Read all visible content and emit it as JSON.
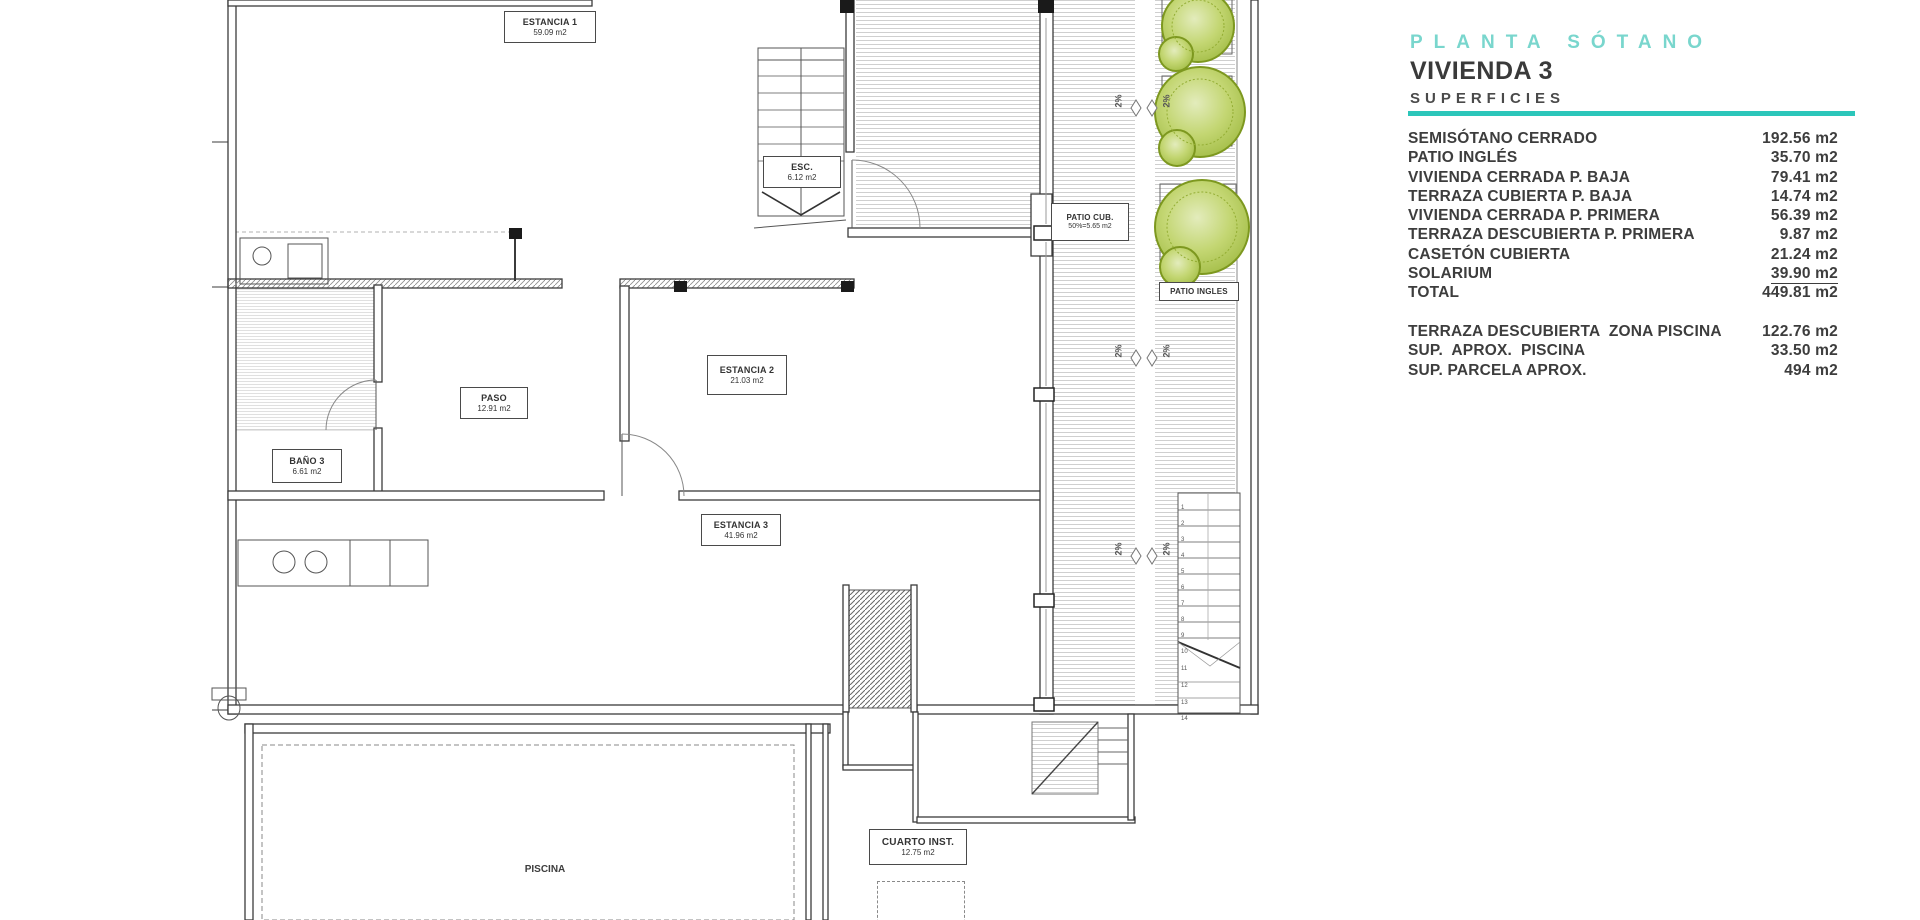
{
  "title_block": {
    "plan_title": "PLANTA SÓTANO",
    "unit_title": "VIVIENDA 3",
    "section_title": "SUPERFICIES",
    "accent_color": "#2cc6ba",
    "rows": [
      {
        "label": "SEMISÓTANO CERRADO",
        "value": "192.56 m2"
      },
      {
        "label": "PATIO INGLÉS",
        "value": "35.70 m2"
      },
      {
        "label": "VIVIENDA CERRADA P. BAJA",
        "value": "79.41 m2"
      },
      {
        "label": "TERRAZA CUBIERTA P. BAJA",
        "value": "14.74 m2"
      },
      {
        "label": "VIVIENDA CERRADA P. PRIMERA",
        "value": "56.39 m2"
      },
      {
        "label": "TERRAZA DESCUBIERTA P. PRIMERA",
        "value": "9.87 m2"
      },
      {
        "label": "CASETÓN CUBIERTA",
        "value": "21.24 m2"
      },
      {
        "label": "SOLARIUM",
        "value": "39.90 m2",
        "underline": true
      },
      {
        "label": "TOTAL",
        "value": "449.81 m2"
      }
    ],
    "extra_rows": [
      {
        "label": "TERRAZA DESCUBIERTA  ZONA PISCINA",
        "value": "122.76 m2"
      },
      {
        "label": "SUP.  APROX.  PISCINA",
        "value": "33.50 m2"
      },
      {
        "label": "SUP. PARCELA APROX.",
        "value": "494 m2"
      }
    ]
  },
  "plan": {
    "rooms": [
      {
        "name": "ESTANCIA 1",
        "area": "59.09 m2"
      },
      {
        "name": "ESC.",
        "area": "6.12 m2"
      },
      {
        "name": "PATIO CUB.",
        "area": "50%=5.65 m2"
      },
      {
        "name": "PASO",
        "area": "12.91 m2"
      },
      {
        "name": "BAÑO 3",
        "area": "6.61 m2"
      },
      {
        "name": "ESTANCIA 2",
        "area": "21.03 m2"
      },
      {
        "name": "ESTANCIA 3",
        "area": "41.96 m2"
      },
      {
        "name": "CUARTO INST.",
        "area": "12.75 m2"
      }
    ],
    "labels": {
      "patio_ingles": "PATIO INGLES",
      "piscina": "PISCINA",
      "maqu": "MAQU.",
      "slope": "2%"
    },
    "stair_numbers": [
      "1",
      "2",
      "3",
      "4",
      "5",
      "6",
      "7",
      "8",
      "9",
      "10",
      "11",
      "12",
      "13",
      "14"
    ]
  }
}
